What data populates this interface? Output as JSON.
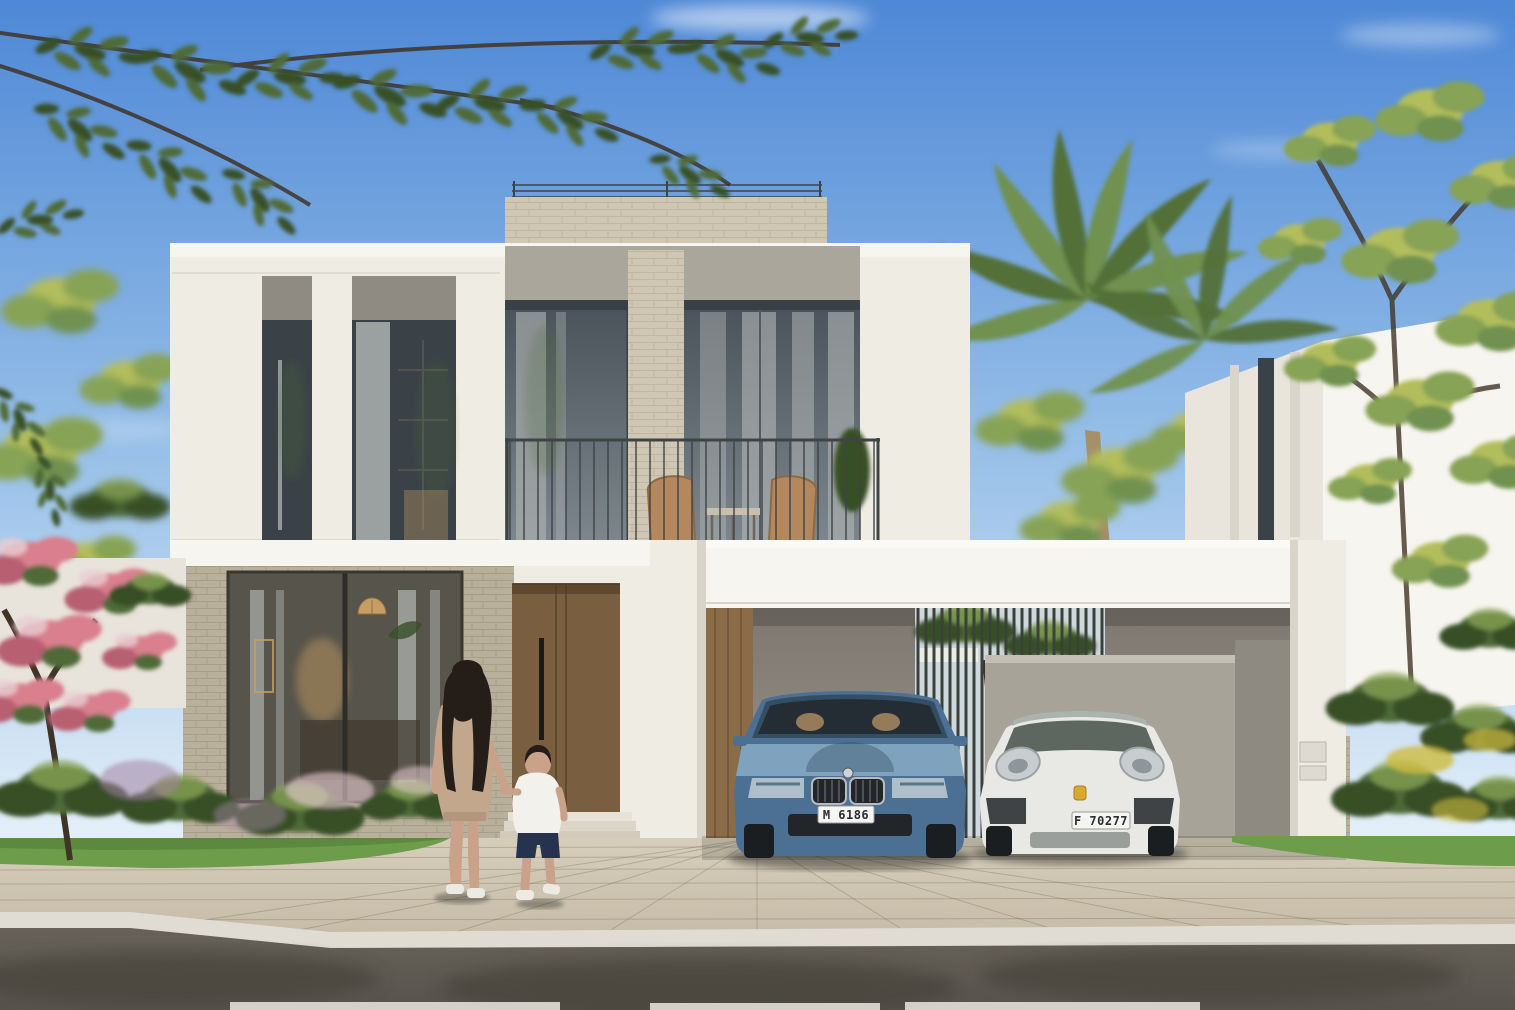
{
  "scene": {
    "title": "Modern two-storey white villa rendering with carport, palm trees, and a woman and boy walking to the entrance",
    "setting": "sunny day, blue sky, landscaped street frontage"
  },
  "colors": {
    "sky_top": "#4e88d6",
    "sky_mid": "#98c0e8",
    "sky_horizon": "#e2eef8",
    "cloud": "#ffffff",
    "facade": "#efece4",
    "facade_bright": "#f7f5ef",
    "facade_shade": "#d9d5cb",
    "soffit": "#aaa69c",
    "stone": "#cfc7b3",
    "stone_dark": "#b9b09b",
    "glass_top": "#49525a",
    "glass_bot": "#7d878d",
    "glass_dark": "#3a4247",
    "curtain": "#b4b8b6",
    "railing": "#3e4345",
    "wood_door": "#7a5e40",
    "wood_door_dark": "#5e4830",
    "wood_panel": "#8c6c48",
    "interior_base": "#57544b",
    "interior_warm": "#c89e63",
    "wall_grey": "#8f8a81",
    "wall_grey_light": "#a7a399",
    "gate_dark": "#3b403a",
    "foliage": "#4f6b38",
    "foliage_dark": "#374f28",
    "foliage_light": "#87a355",
    "foliage_yellow": "#b2bd5c",
    "palm": "#6f9150",
    "palm_dark": "#527039",
    "trunk": "#3f3426",
    "palm_trunk": "#a5906b",
    "flower_pink": "#d97f8e",
    "flower_pink_dark": "#b85f72",
    "flower_pale": "#e9cdd3",
    "flower_purple": "#a384a0",
    "flower_yellow": "#cdbb3e",
    "grass": "#6d9c4a",
    "grass_dark": "#547b38",
    "paver": "#d6cdba",
    "paver_dark": "#c2b8a4",
    "curb": "#e0dcd3",
    "road": "#676259",
    "road_shadow": "#3f3c36",
    "marking": "#eae8e1",
    "car_blue": "#4c7094",
    "car_blue_light": "#7fa3bd",
    "car_blue_dark": "#334d63",
    "car_glass": "#242d34",
    "car_interior_tan": "#a98a62",
    "car_white": "#e8e8e4",
    "car_white_shade": "#c7c8c3",
    "car_roof_grey": "#aab3ac",
    "car_detail_dark": "#22262a",
    "chrome": "#b9bcbe",
    "plate_bg": "#f5f5f1",
    "plate_text": "#2a2d33",
    "crest_yellow": "#d9a82e",
    "skin": "#c9a289",
    "hair_dark": "#241d18",
    "dress_tan": "#c2a78c",
    "dress_tan_dark": "#a78c72",
    "shirt_white": "#f2f1ec",
    "shorts_navy": "#27334e",
    "shoe_white": "#eceae3",
    "wicker": "#b4885c",
    "wicker_dark": "#8d6a45"
  },
  "vehicles": {
    "sedan": {
      "body": "blue sedan",
      "plate": "M 6186"
    },
    "coupe": {
      "body": "white sports car",
      "plate": "F 70277"
    }
  },
  "figures": {
    "woman": "woman in beige dress with long dark hair",
    "boy": "boy in white t-shirt and navy shorts"
  }
}
